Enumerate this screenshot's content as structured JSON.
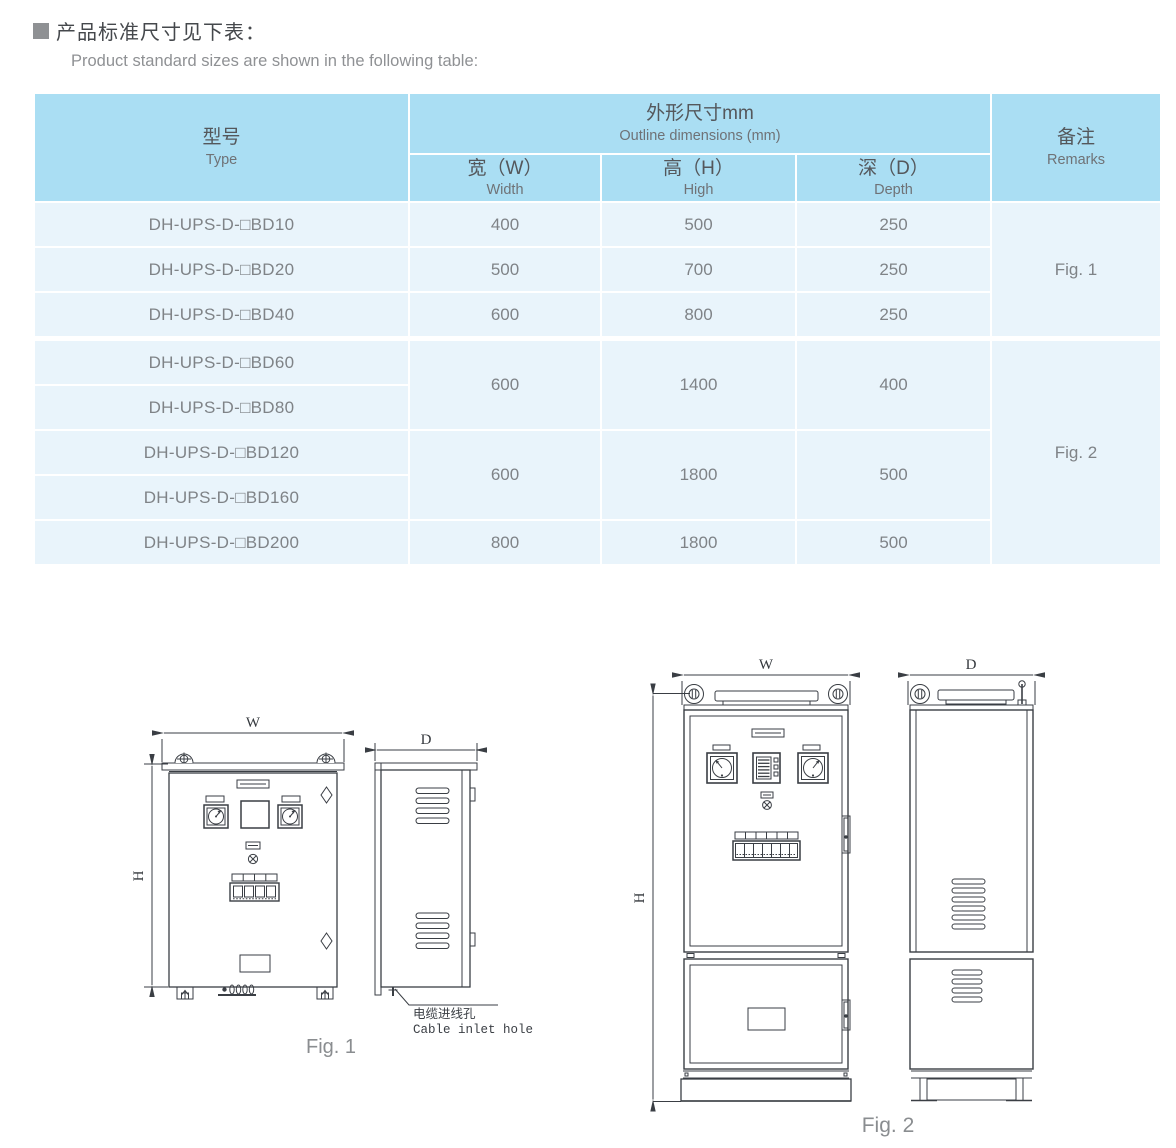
{
  "document": {
    "title_cn": "产品标准尺寸见下表：",
    "title_en": "Product standard sizes are shown in the following table:"
  },
  "table": {
    "header": {
      "type_cn": "型号",
      "type_en": "Type",
      "outline_cn": "外形尺寸mm",
      "outline_en": "Outline dimensions (mm)",
      "width_cn": "宽（W）",
      "width_en": "Width",
      "high_cn": "高（H）",
      "high_en": "High",
      "depth_cn": "深（D）",
      "depth_en": "Depth",
      "remarks_cn": "备注",
      "remarks_en": "Remarks"
    },
    "rows": [
      {
        "type": "DH-UPS-D-□BD10",
        "w": "400",
        "h": "500",
        "d": "250"
      },
      {
        "type": "DH-UPS-D-□BD20",
        "w": "500",
        "h": "700",
        "d": "250"
      },
      {
        "type": "DH-UPS-D-□BD40",
        "w": "600",
        "h": "800",
        "d": "250"
      },
      {
        "type": "DH-UPS-D-□BD60",
        "w": "600",
        "h": "1400",
        "d": "400"
      },
      {
        "type": "DH-UPS-D-□BD80"
      },
      {
        "type": "DH-UPS-D-□BD120",
        "w": "600",
        "h": "1800",
        "d": "500"
      },
      {
        "type": "DH-UPS-D-□BD160"
      },
      {
        "type": "DH-UPS-D-□BD200",
        "w": "800",
        "h": "1800",
        "d": "500"
      }
    ],
    "remarks": {
      "fig1": "Fig. 1",
      "fig2": "Fig. 2"
    }
  },
  "fig1": {
    "caption": "Fig. 1",
    "dims": {
      "w": "W",
      "h": "H",
      "d": "D"
    },
    "cable_cn": "电缆进线孔",
    "cable_en": "Cable inlet hole"
  },
  "fig2": {
    "caption": "Fig. 2",
    "dims": {
      "w": "W",
      "h": "H",
      "d": "D"
    }
  },
  "colors": {
    "header_bg": "#aadef3",
    "row_bg": "#e9f4fb",
    "table_text": "#7f8387",
    "header_text": "#54575b",
    "drawing_line": "#3a3e44",
    "bullet": "#8f9194"
  }
}
